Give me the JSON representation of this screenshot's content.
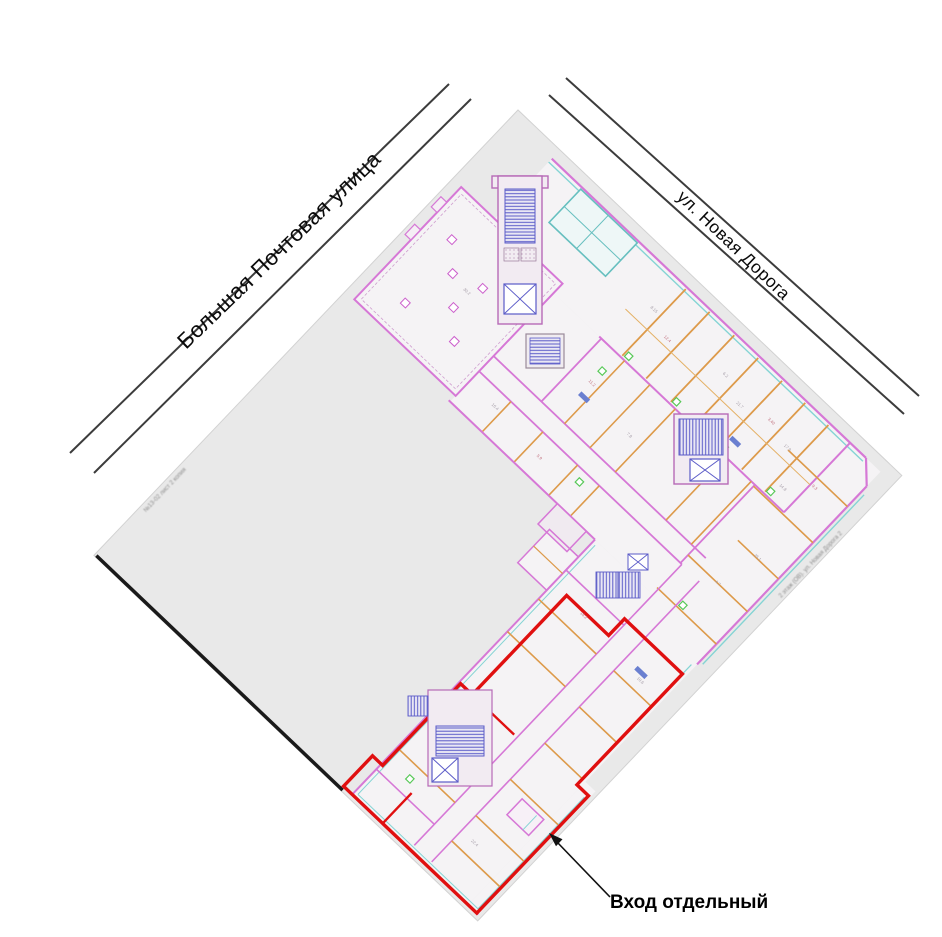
{
  "streets": {
    "left_label": "Большая Почтовая улица",
    "right_label": "ул. Новая Дорога"
  },
  "annotation": {
    "entrance_label": "Вход отдельный"
  },
  "edge_stamps": {
    "left": "№13-02 лист 2 копия",
    "right": "2 этаж (ОВ). ул. Новая Дорога 2"
  },
  "colors": {
    "sheet": "#e9e9e9",
    "room_fill": "#f5f3f5",
    "wall_pink": "#d678d6",
    "partition_orange": "#dd9a4a",
    "window_cyan": "#84d4d4",
    "stair_blue": "#5b5bc8",
    "fixture_green": "#58c858",
    "highlight_red": "#e01010",
    "street_line": "#3c3c3c",
    "edge_black": "#1a1a1a"
  },
  "plan_specks": [
    {
      "t": "8.15",
      "u": 232,
      "v": 52,
      "c": "#a59da8"
    },
    {
      "t": "12.4",
      "u": 262,
      "v": 64,
      "c": "#c0707e"
    },
    {
      "t": "6.2",
      "u": 330,
      "v": 50,
      "c": "#a59da8"
    },
    {
      "t": "21.7",
      "u": 360,
      "v": 62,
      "c": "#a59da8"
    },
    {
      "t": "3.40",
      "u": 394,
      "v": 52,
      "c": "#c0707e"
    },
    {
      "t": "17.9",
      "u": 424,
      "v": 60,
      "c": "#a59da8"
    },
    {
      "t": "14.8",
      "u": 448,
      "v": 92,
      "c": "#a59da8"
    },
    {
      "t": "9.3",
      "u": 472,
      "v": 70,
      "c": "#c0707e"
    },
    {
      "t": "25.1",
      "u": 478,
      "v": 160,
      "c": "#a59da8"
    },
    {
      "t": "4.7",
      "u": 468,
      "v": 206,
      "c": "#a59da8"
    },
    {
      "t": "11.2",
      "u": 238,
      "v": 148,
      "c": "#c0707e"
    },
    {
      "t": "7.8",
      "u": 302,
      "v": 160,
      "c": "#a59da8"
    },
    {
      "t": "16.4",
      "u": 184,
      "v": 232,
      "c": "#a59da8"
    },
    {
      "t": "5.9",
      "u": 252,
      "v": 238,
      "c": "#c0707e"
    },
    {
      "t": "18.2",
      "u": 392,
      "v": 322,
      "c": "#c0707e"
    },
    {
      "t": "10.6",
      "u": 478,
      "v": 330,
      "c": "#a59da8"
    },
    {
      "t": "13.1",
      "u": 396,
      "v": 520,
      "c": "#c0707e"
    },
    {
      "t": "22.4",
      "u": 470,
      "v": 562,
      "c": "#a59da8"
    },
    {
      "t": "30.2",
      "u": 84,
      "v": 168,
      "c": "#a59da8"
    },
    {
      "t": "2.14",
      "u": 128,
      "v": 120,
      "c": "#c0707e"
    }
  ]
}
